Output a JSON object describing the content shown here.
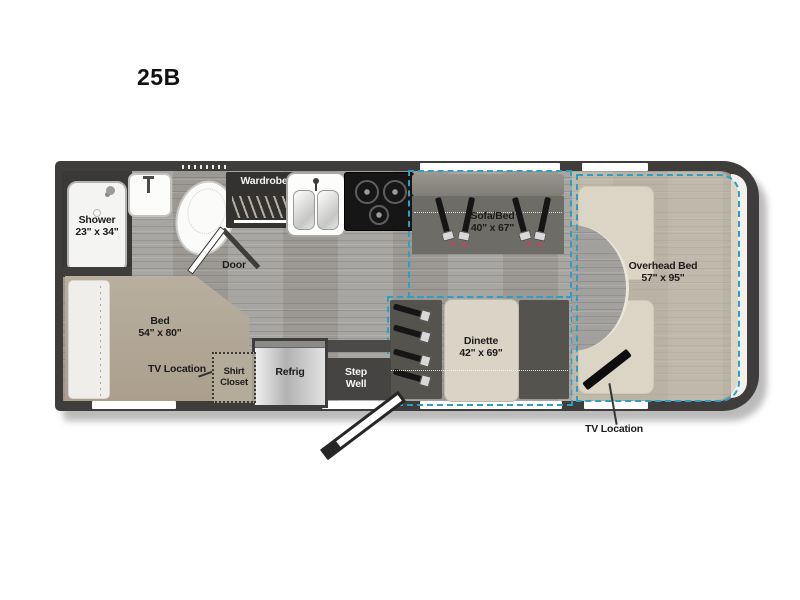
{
  "title": "25B",
  "colors": {
    "accent_teal": "#2f9fc0",
    "wall": "#3e3d3c",
    "bed_tan": "#b4ab99",
    "sofa_gray": "#6e6c66"
  },
  "labels": {
    "shower": {
      "name": "Shower",
      "dims": "23\" x 34\""
    },
    "wardrobe": "Wardrobe",
    "door": "Door",
    "sofa": {
      "name": "Sofa/Bed",
      "dims": "40\" x 67\""
    },
    "overhead": {
      "name": "Overhead Bed",
      "dims": "57\" x 95\""
    },
    "bed": {
      "name": "Bed",
      "dims": "54\" x 80\""
    },
    "tv_bedroom": "TV Location",
    "shirt_closet": "Shirt Closet",
    "refrig": "Refrig",
    "step_well": "Step Well",
    "dinette": {
      "name": "Dinette",
      "dims": "42\" x 69\""
    },
    "tv_cab": "TV Location"
  }
}
